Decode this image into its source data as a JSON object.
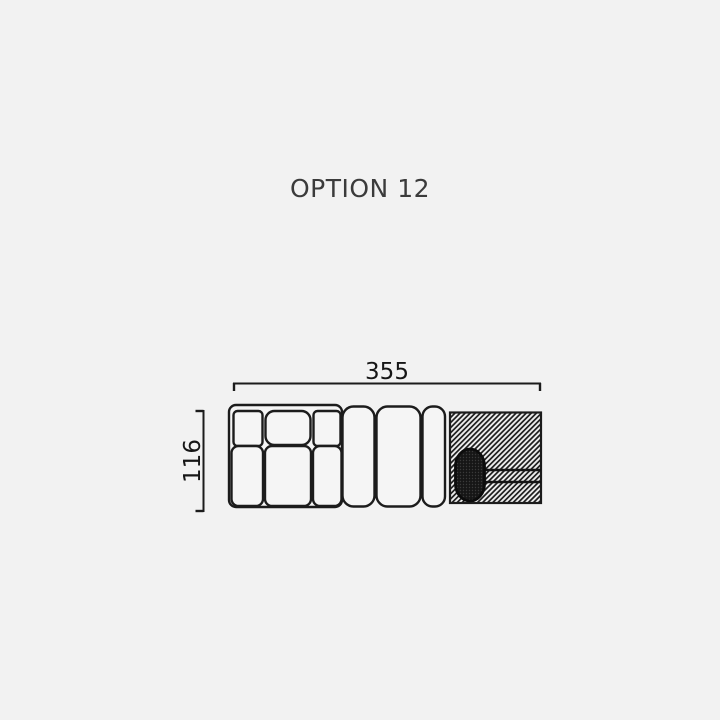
{
  "title": "OPTION 12",
  "diagram": {
    "name": "sofa-top-view-plan",
    "dimensions": {
      "width_label": "355",
      "height_label": "116"
    },
    "parts": {
      "left_section": "sofa-section-with-back-cushions",
      "back_cushion_count": 3,
      "seat_cushion_count": 3,
      "bench_cushion_count": 3,
      "right_panel": "hatched-side-platform",
      "oval_element": "dark-oval-bolster"
    },
    "colors": {
      "background": "#f2f2f2",
      "line": "#1c1c1c",
      "cushion_fill": "#f5f5f5",
      "hatch_dark": "#1b1b1b",
      "hatch_light": "#eeeeee",
      "oval_fill": "#161616",
      "title_text": "#3b3b3b",
      "dimension_text": "#161616"
    }
  }
}
